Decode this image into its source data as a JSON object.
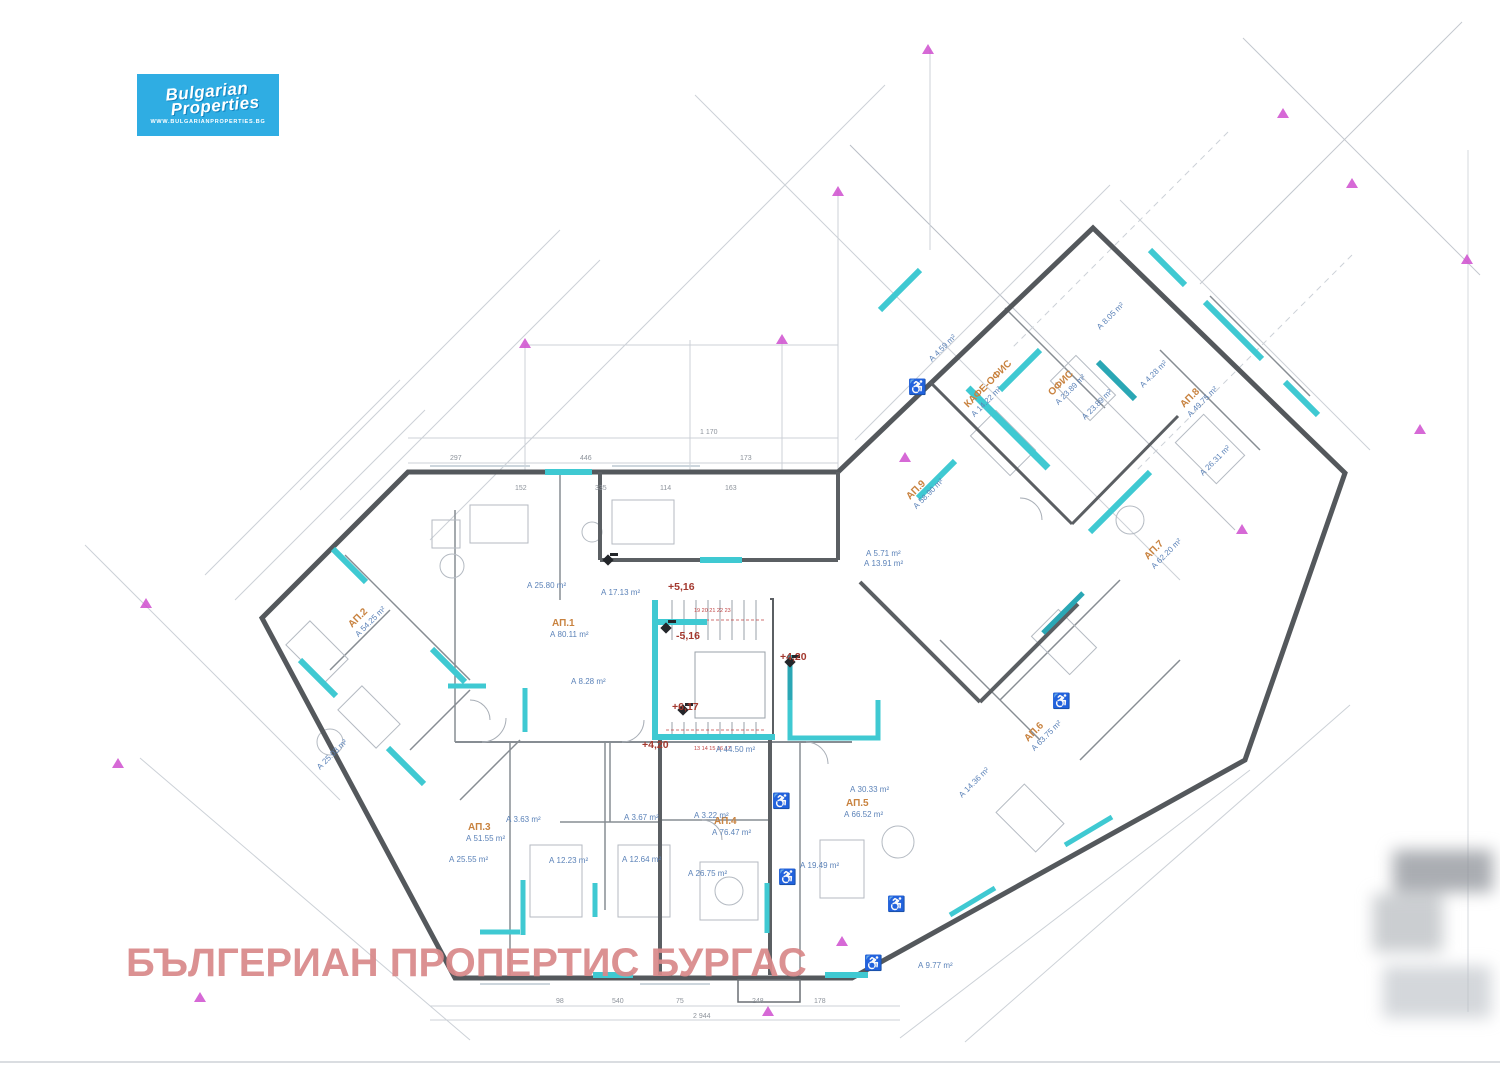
{
  "logo": {
    "title_line1": "Bulgarian",
    "title_line2": "Properties",
    "url": "WWW.BULGARIANPROPERTIES.BG"
  },
  "watermark": "БЪЛГЕРИАН ПРОПЕРТИС БУРГАС",
  "colors": {
    "wall": "#54585c",
    "highlight_cyan": "#3fc9d2",
    "teal_dark": "#2aa7b5",
    "apartment_label_orange": "#c8823f",
    "area_label_blue": "#5b82b8",
    "elevation_red": "#a3382e",
    "axis_marker_magenta": "#cf4fcf",
    "logo_background": "#2fade3",
    "watermark_pink": "#d9898a"
  },
  "plan": {
    "apartments": [
      {
        "name": "АП.1",
        "area": "А 80.11 m²"
      },
      {
        "name": "АП.2",
        "area": "А 54.25 m²"
      },
      {
        "name": "АП.3",
        "area": "А 51.55 m²"
      },
      {
        "name": "АП.4",
        "area": "А 76.47 m²"
      },
      {
        "name": "АП.5",
        "area": "А 66.52 m²"
      },
      {
        "name": "АП.6",
        "area": "А 63.75 m²"
      },
      {
        "name": "АП.7",
        "area": "А 62.20 m²"
      },
      {
        "name": "АП.8",
        "area": "А 49.75 m²"
      },
      {
        "name": "АП.9",
        "area": "А 58.90 m²"
      },
      {
        "name": "КАФЕ-ОФИС",
        "area": "А 14.22 m²"
      },
      {
        "name": "ОФИС",
        "area": "А 23.89 m²"
      }
    ],
    "rooms": [
      "А 25.80 m²",
      "А 17.13 m²",
      "А 13.91 m²",
      "А 8.28 m²",
      "А 44.50 m²",
      "А 25.55 m²",
      "А 12.23 m²",
      "А 12.64 m²",
      "А 26.75 m²",
      "А 19.49 m²",
      "А 30.33 m²",
      "А 14.36 m²",
      "А 9.77 m²",
      "А 3.63 m²",
      "А 3.67 m²",
      "А 3.22 m²",
      "А 25.03 m²",
      "А 8.05 m²",
      "А 26.31 m²",
      "А 4.59 m²",
      "А 4.28 m²",
      "А 5.71 m²",
      "А 23.89 m²"
    ],
    "elevations": [
      "+5,16",
      "-5,16",
      "+4,20",
      "+6,17",
      "+4,20"
    ],
    "dimensions": [
      "1 170",
      "297",
      "446",
      "173",
      "152",
      "335",
      "114",
      "163",
      "2 944",
      "540",
      "98",
      "75",
      "248",
      "178"
    ],
    "stairs": {
      "upper_steps": "19 20 21 22 23",
      "lower_steps": "13 14 15 16 17"
    },
    "icons": {
      "wheelchair": "♿"
    }
  }
}
